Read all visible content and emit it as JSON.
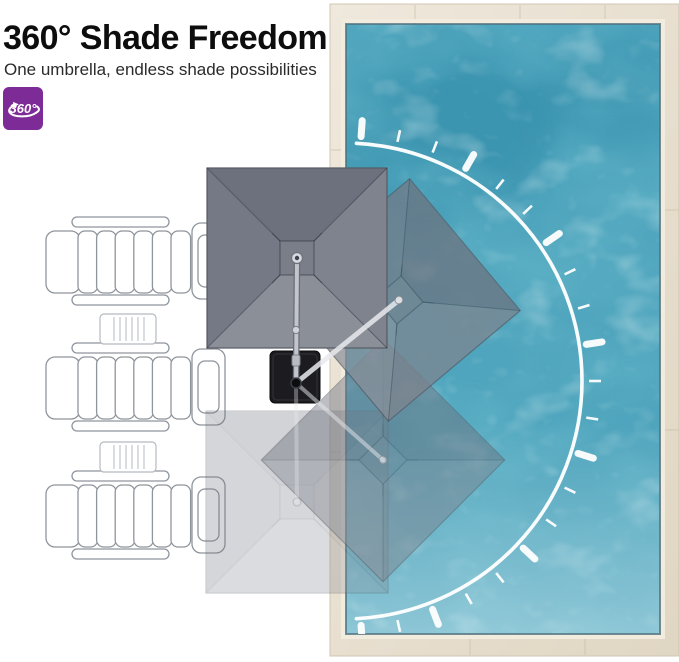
{
  "header": {
    "title": "360° Shade Freedom",
    "subtitle": "One umbrella, endless shade possibilities",
    "badge_label": "360°"
  },
  "icons": {
    "badge": "rotation-360-icon"
  },
  "colors": {
    "accent_purple": "#7d2b97",
    "page_bg": "#ffffff",
    "water": "#4fa5bd",
    "water_dark_patch": "#2c86a4",
    "deck_light": "#efe8dc",
    "deck_dark": "#e0d6c3",
    "deck_seam": "#c3b69c",
    "coping_light": "#f2ecdf",
    "water_edge": "#4e707e",
    "arc_white": "#ffffff",
    "canopy_top": "#6d717d",
    "canopy_right": "#7f838d",
    "canopy_bottom": "#8b8f98",
    "canopy_left": "#757985",
    "canopy_vent": "#7a7e88",
    "canopy_outline": "#575b65",
    "canopy_seam": "rgba(35,40,50,0.45)",
    "base_black": "#1c1c20",
    "pole_light": "#c2c5cc",
    "pole_dark": "#696d77",
    "arm_ghost": "#e8eaee",
    "chair_outline": "#8f959c",
    "table_outline": "#b5bac0"
  },
  "scene": {
    "pool": {
      "x": 330,
      "y": 4,
      "width": 349,
      "height": 652,
      "water_x": 346,
      "water_y": 24,
      "water_width": 314,
      "water_height": 610,
      "deck_seams": [
        {
          "x1": 415,
          "y1": 5,
          "x2": 415,
          "y2": 24
        },
        {
          "x1": 520,
          "y1": 5,
          "x2": 520,
          "y2": 24
        },
        {
          "x1": 605,
          "y1": 5,
          "x2": 605,
          "y2": 24
        },
        {
          "x1": 331,
          "y1": 150,
          "x2": 346,
          "y2": 150
        },
        {
          "x1": 331,
          "y1": 300,
          "x2": 346,
          "y2": 300
        },
        {
          "x1": 331,
          "y1": 452,
          "x2": 346,
          "y2": 452
        },
        {
          "x1": 470,
          "y1": 634,
          "x2": 470,
          "y2": 655
        },
        {
          "x1": 585,
          "y1": 634,
          "x2": 585,
          "y2": 655
        },
        {
          "x1": 660,
          "y1": 210,
          "x2": 679,
          "y2": 210
        },
        {
          "x1": 660,
          "y1": 430,
          "x2": 679,
          "y2": 430
        }
      ]
    },
    "dial": {
      "cx": 344,
      "cy": 381,
      "radius": 238,
      "arc_start_deg": -87,
      "arc_end_deg": 87,
      "tick_start_deg": -86,
      "tick_count": 21,
      "tick_step_deg": 8.6,
      "major_every": 3,
      "gap": 7,
      "minor_len": 12,
      "minor_width": 2.6,
      "major_len": 16,
      "major_width": 7
    },
    "base": {
      "x": 270,
      "y": 351,
      "width": 50,
      "height": 52,
      "pivot_x": 296,
      "pivot_y": 383
    },
    "umbrellas": [
      {
        "name": "south-ghost",
        "cx": 297,
        "cy": 502,
        "size": 182,
        "rotation": 0,
        "opacity": 0.3
      },
      {
        "name": "southeast-ghost",
        "cx": 383,
        "cy": 460,
        "size": 172,
        "rotation": 45,
        "opacity": 0.48
      },
      {
        "name": "northeast-ghost",
        "cx": 399,
        "cy": 300,
        "size": 172,
        "rotation": 50,
        "opacity": 0.72
      },
      {
        "name": "north-main",
        "cx": 297,
        "cy": 258,
        "size": 180,
        "rotation": 0,
        "opacity": 1
      }
    ],
    "pole_joint": {
      "x": 296,
      "y": 330
    },
    "chairs": [
      {
        "x": 46,
        "y": 217
      },
      {
        "x": 46,
        "y": 343
      },
      {
        "x": 46,
        "y": 471
      }
    ],
    "tables": [
      {
        "x": 100,
        "y": 314
      },
      {
        "x": 100,
        "y": 442
      }
    ]
  }
}
